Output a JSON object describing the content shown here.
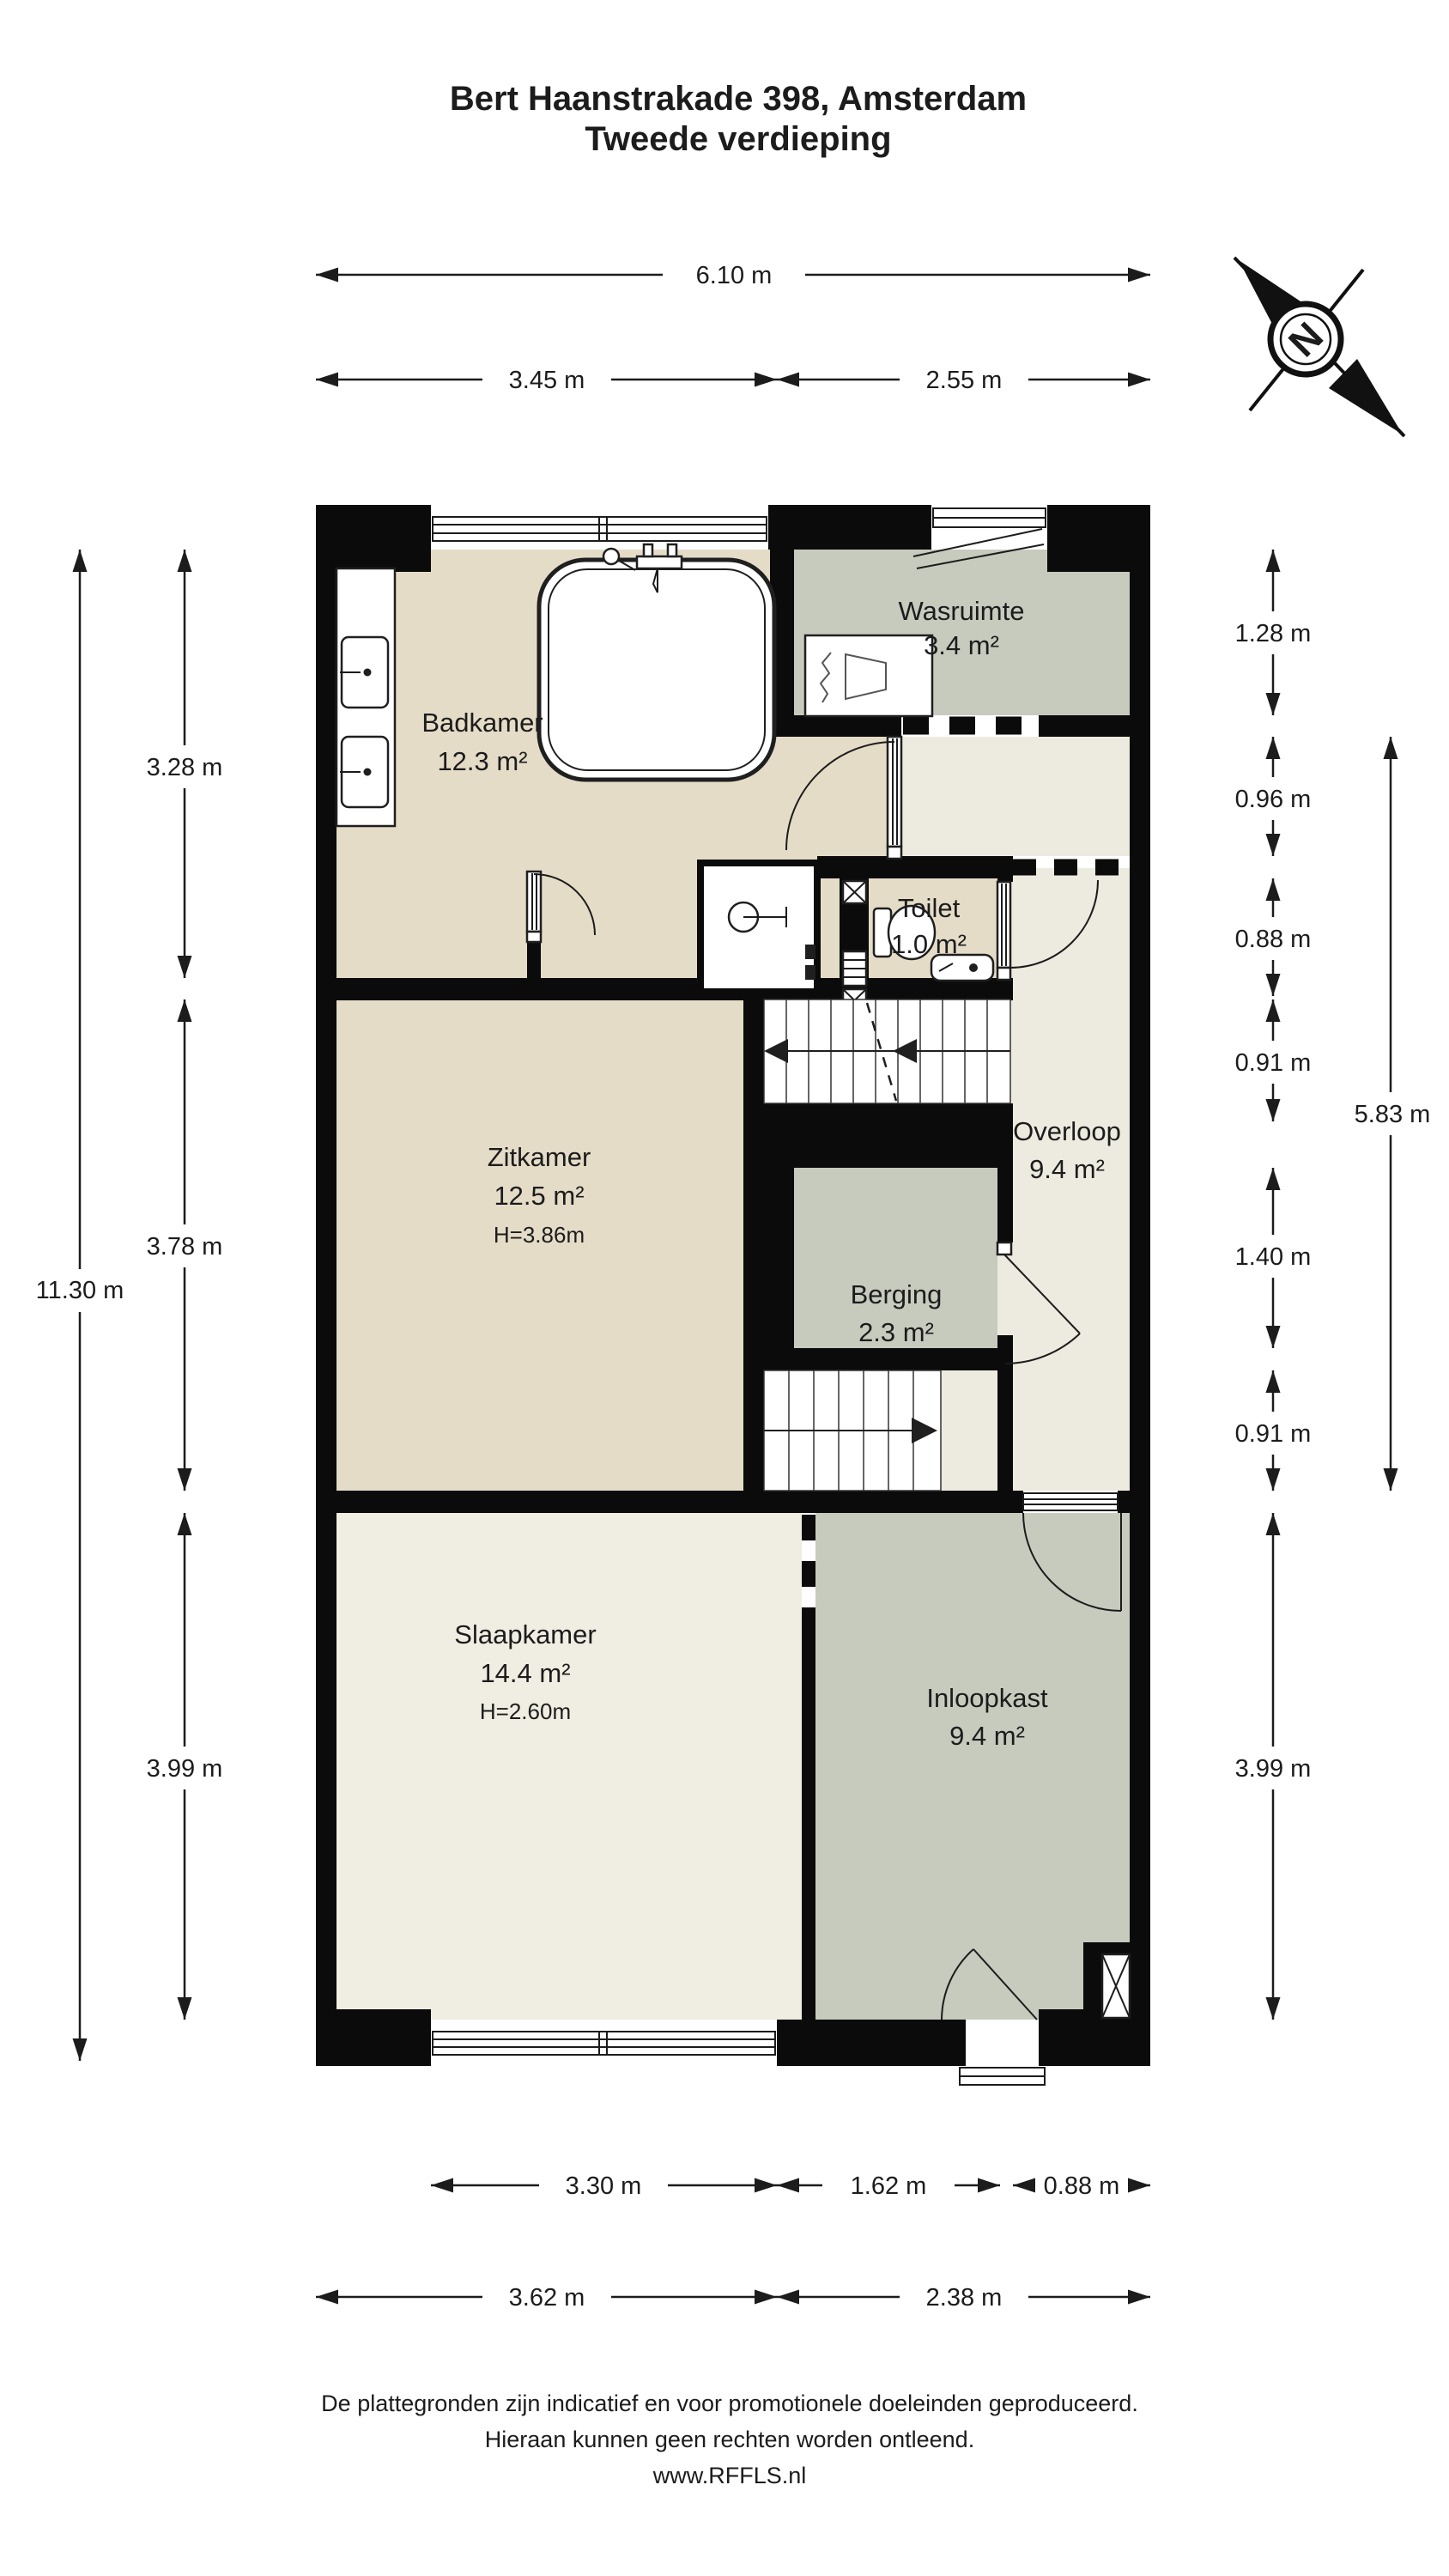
{
  "title": {
    "line1": "Bert Haanstrakade 398, Amsterdam",
    "line2": "Tweede verdieping"
  },
  "compass": {
    "north_label": "N"
  },
  "rooms": {
    "badkamer": {
      "name": "Badkamer",
      "area": "12.3 m²"
    },
    "wasruimte": {
      "name": "Wasruimte",
      "area": "3.4 m²"
    },
    "toilet": {
      "name": "Toilet",
      "area": "1.0 m²"
    },
    "zitkamer": {
      "name": "Zitkamer",
      "area": "12.5 m²",
      "height": "H=3.86m"
    },
    "overloop": {
      "name": "Overloop",
      "area": "9.4 m²"
    },
    "berging": {
      "name": "Berging",
      "area": "2.3 m²"
    },
    "slaapkamer": {
      "name": "Slaapkamer",
      "area": "14.4 m²",
      "height": "H=2.60m"
    },
    "inloopkast": {
      "name": "Inloopkast",
      "area": "9.4 m²"
    }
  },
  "dimensions": {
    "top_total": "6.10 m",
    "top_left": "3.45 m",
    "top_right": "2.55 m",
    "left_total": "11.30 m",
    "left_seg1": "3.28 m",
    "left_seg2": "3.78 m",
    "left_seg3": "3.99 m",
    "right_seg1": "1.28 m",
    "right_seg2": "0.96 m",
    "right_seg3": "0.88 m",
    "right_seg4": "0.91 m",
    "right_seg5": "1.40 m",
    "right_seg6": "0.91 m",
    "right_seg7": "3.99 m",
    "right_span": "5.83 m",
    "bottom1_left": "3.30 m",
    "bottom1_mid": "1.62 m",
    "bottom1_right": "0.88 m",
    "bottom2_left": "3.62 m",
    "bottom2_right": "2.38 m"
  },
  "footer": {
    "line1": "De plattegronden zijn indicatief en voor promotionele doeleinden geproduceerd.",
    "line2": "Hieraan kunnen geen rechten worden ontleend.",
    "line3": "www.RFFLS.nl"
  },
  "colors": {
    "wall": "#0b0b0b",
    "ink": "#1c1c1c",
    "floor-beige": "#e5dcc8",
    "floor-gray": "#c7cbbe",
    "floor-cream": "#f0ede2",
    "floor-offwhite": "#edebdf"
  }
}
